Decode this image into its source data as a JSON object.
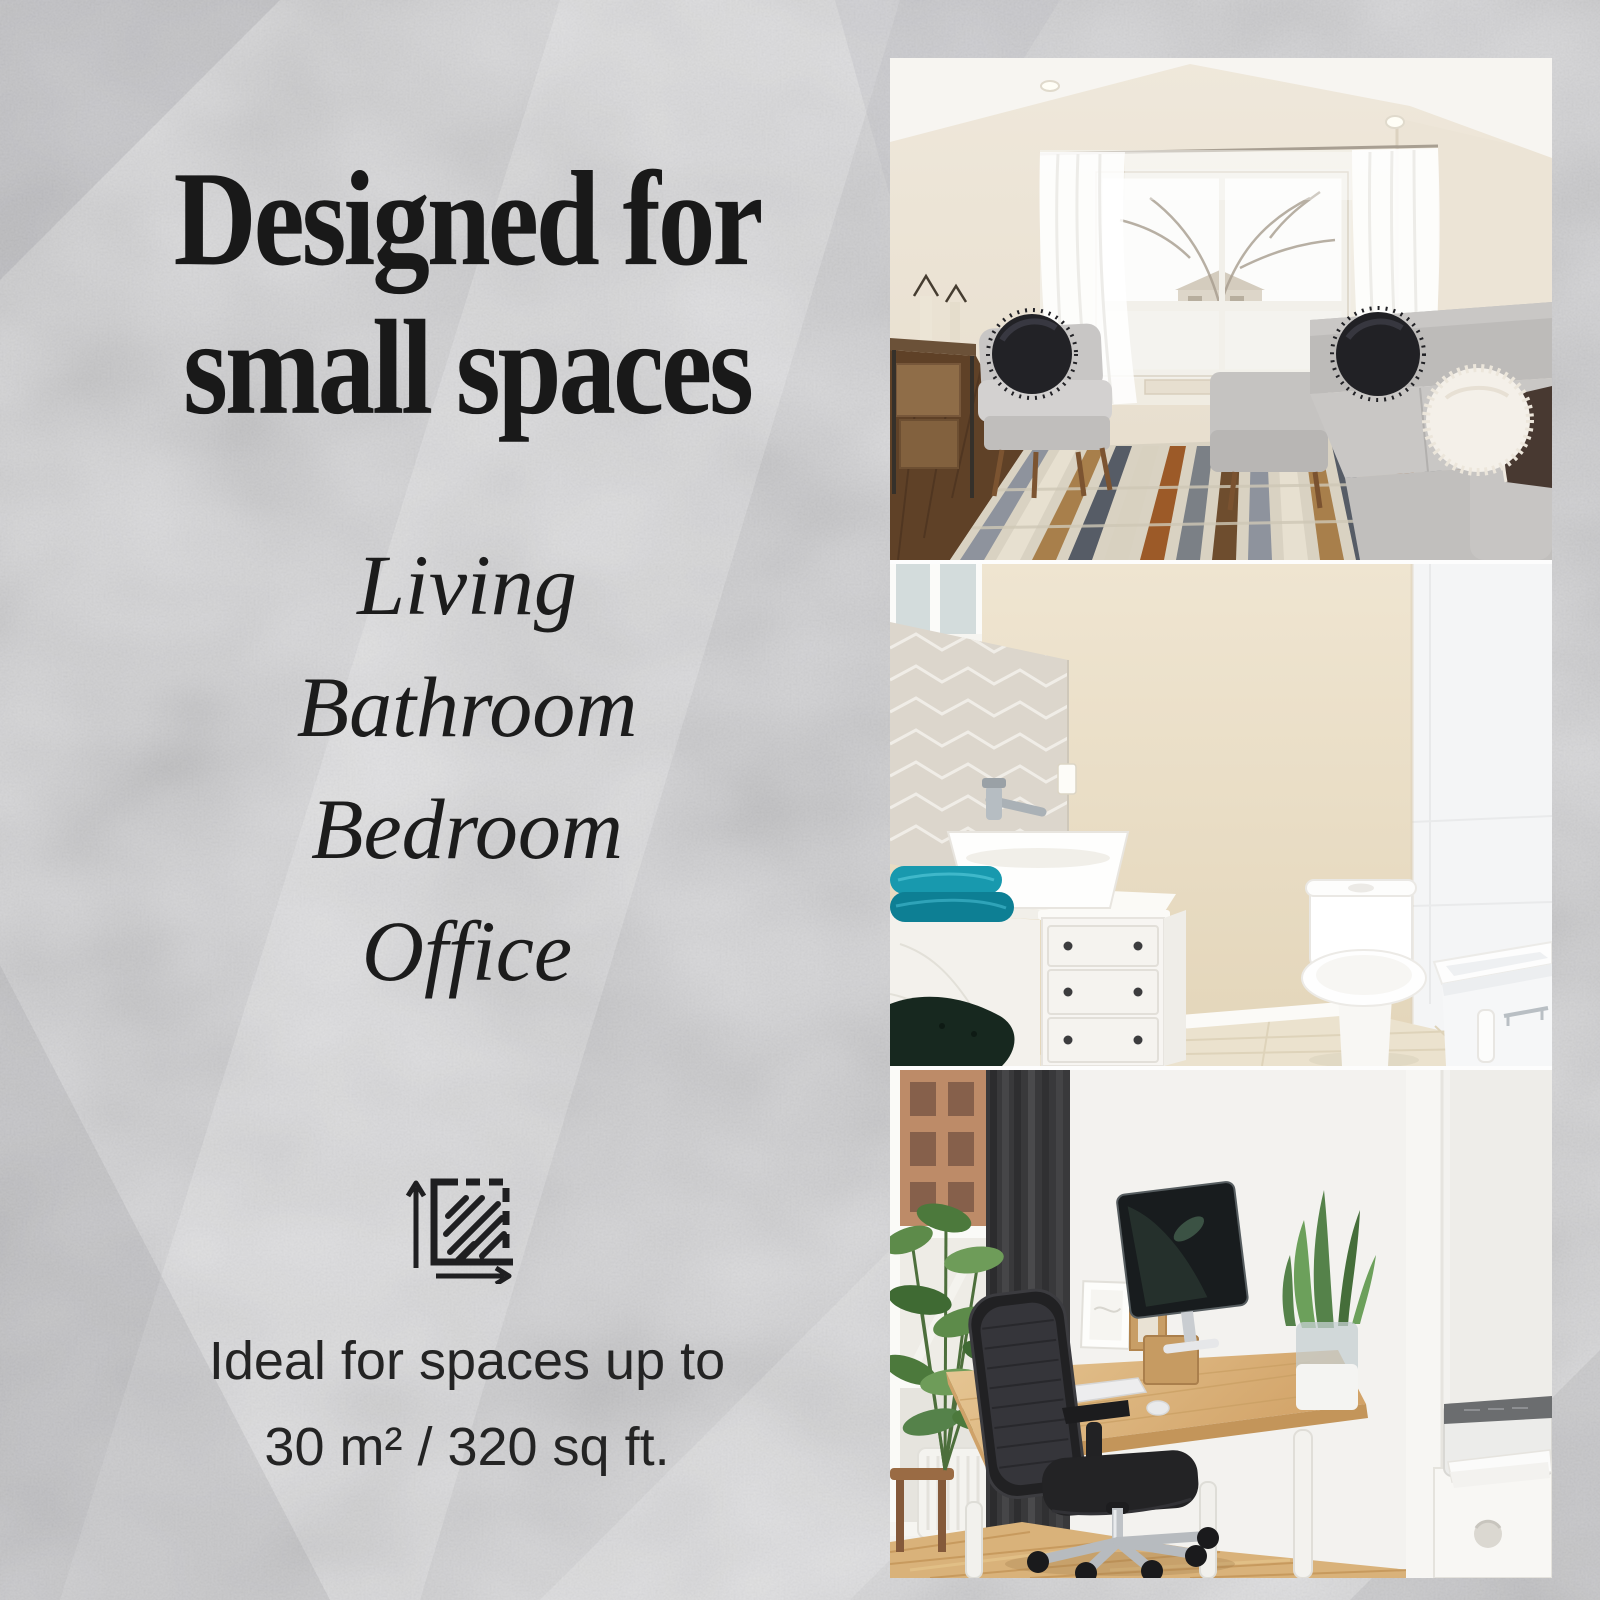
{
  "poster": {
    "headline": {
      "line1": "Designed for",
      "line2": "small spaces"
    },
    "rooms": [
      "Living",
      "Bathroom",
      "Bedroom",
      "Office"
    ],
    "area": {
      "icon": "area-dimensions-icon",
      "caption_line1": "Ideal for spaces up to",
      "caption_line2": "30 m² / 320 sq ft."
    },
    "photos": [
      {
        "name": "living-room",
        "description": "Bright living room with sheer-curtained window, gray sectional sofa, accent chair with black pillow and geometric rug"
      },
      {
        "name": "bathroom",
        "description": "Bathroom with herringbone tile, white vanity with vessel sink, teal towels, toilet and bathtub"
      },
      {
        "name": "home-office",
        "description": "Home office with window, dark curtain, plants, wooden desk, black mesh chair, monitor and printer on white cabinet"
      }
    ],
    "colors": {
      "background": "#d7d7d9",
      "text": "#1a1a1a",
      "photo_gap": "#fdfdfd"
    }
  }
}
